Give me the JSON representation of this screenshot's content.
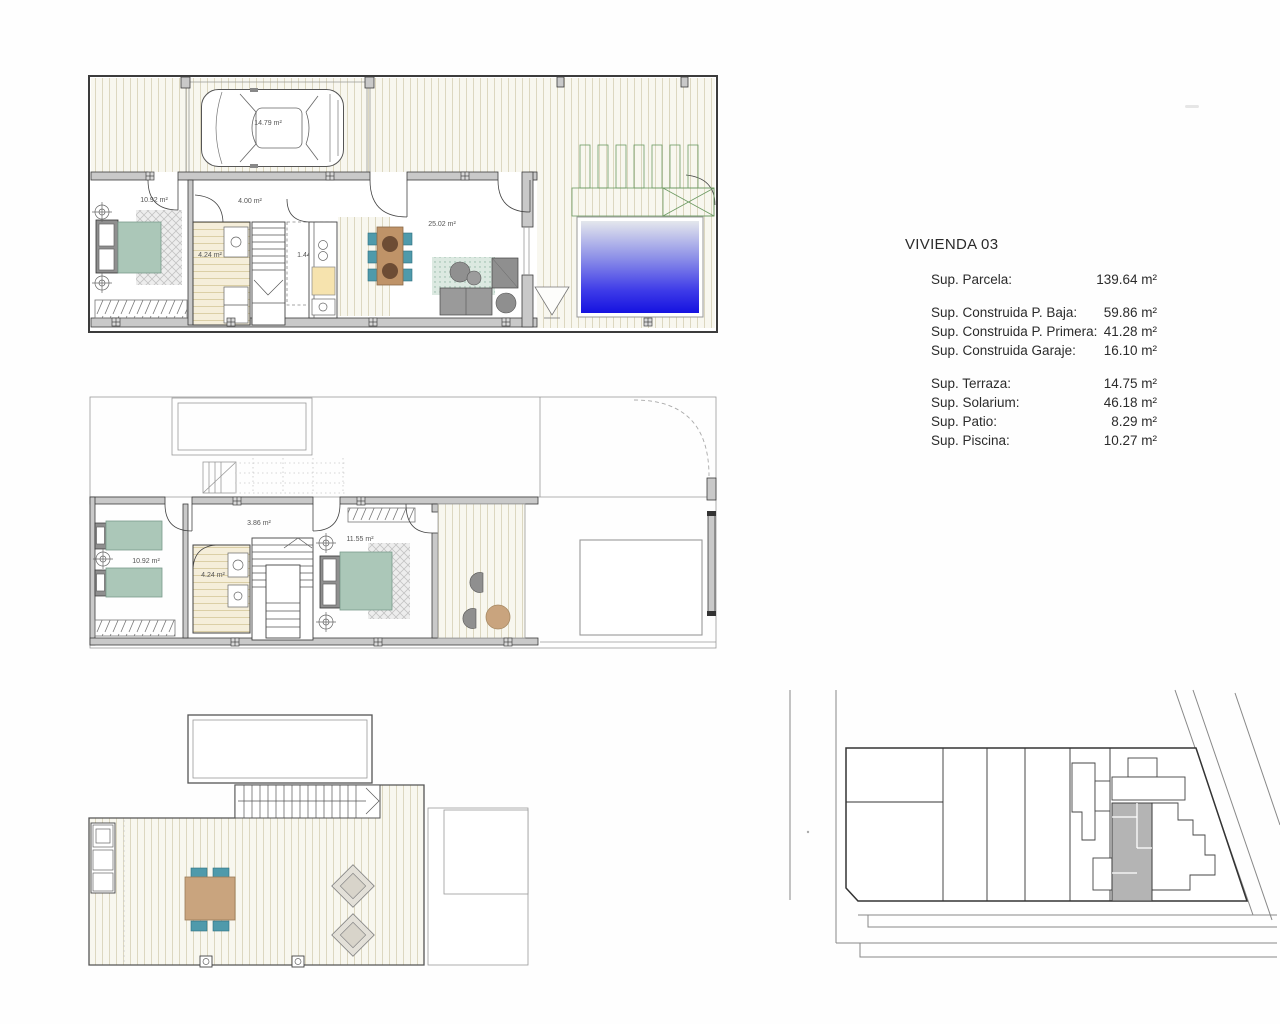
{
  "info_panel": {
    "title": "VIVIENDA 03",
    "rows": [
      {
        "label": "Sup. Parcela:",
        "value": "139.64 m²"
      },
      {
        "label": "Sup. Construida P. Baja:",
        "value": "59.86 m²"
      },
      {
        "label": "Sup. Construida P. Primera:",
        "value": "41.28 m²"
      },
      {
        "label": "Sup. Construida Garaje:",
        "value": "16.10 m²"
      },
      {
        "label": "Sup. Terraza:",
        "value": "14.75 m²"
      },
      {
        "label": "Sup. Solarium:",
        "value": "46.18 m²"
      },
      {
        "label": "Sup. Patio:",
        "value": "8.29 m²"
      },
      {
        "label": "Sup. Piscina:",
        "value": "10.27 m²"
      }
    ]
  },
  "plans": {
    "ground_floor": {
      "labels": {
        "garage": "14.79 m²",
        "bedroom": "10.92 m²",
        "hall": "4.00 m²",
        "bathroom": "4.24 m²",
        "laundry": "1.44 m²",
        "living_dining": "25.02 m²"
      }
    },
    "first_floor": {
      "labels": {
        "bedroom_2": "10.92 m²",
        "landing": "3.86 m²",
        "bathroom": "4.24 m²",
        "bedroom_1": "11.55 m²"
      }
    }
  },
  "colors": {
    "wall": "#c9c9c9",
    "furniture_sage": "#abc7b8",
    "chair_teal": "#4f9aab",
    "table_wood": "#bf9368",
    "table_wood_light": "#c9a47e",
    "pool_blue": "#1a16e2",
    "planter_green": "#cfe2c4",
    "site_highlight": "#b4b4b4"
  }
}
